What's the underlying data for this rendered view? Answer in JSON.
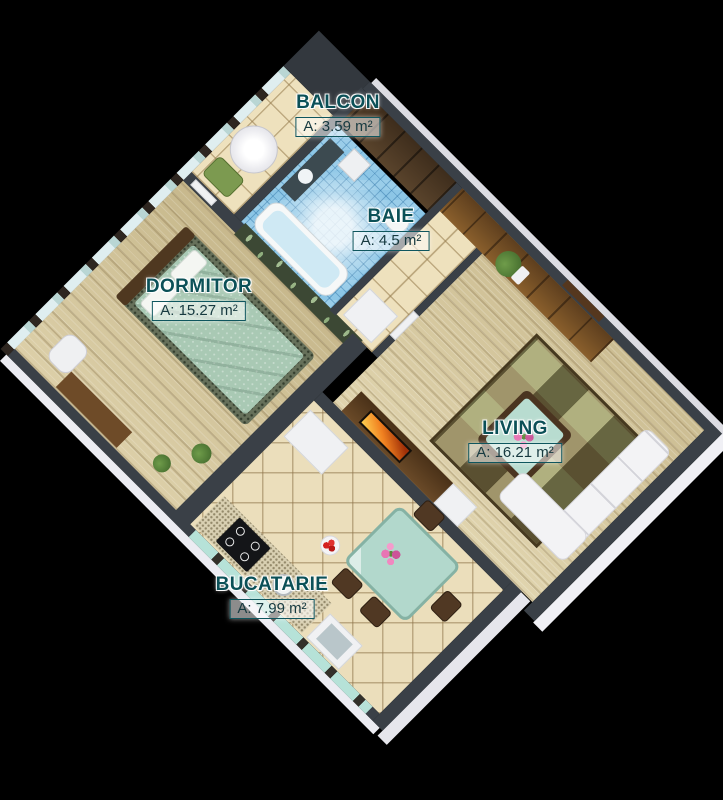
{
  "scene": {
    "description": "3D isometric apartment floor plan render on black background",
    "background": "#000000",
    "palette": {
      "label_text": "#0b5057",
      "label_box_border": "#0f565e",
      "label_box_bg": "rgba(255,255,255,0.55)",
      "wall_top": "#3a4047",
      "wall_face_white": "#ececf2",
      "wood_floor": "#d6c8a0",
      "tile_floor": "#eee1bd",
      "bath_mosaic": "#8cc6e6",
      "bed_cover": "#a9c9b4",
      "accent_leaf_wall": "#3c4834",
      "kitchen_glass": "#b6e2d8"
    }
  },
  "rooms": [
    {
      "id": "balcon",
      "name": "BALCON",
      "area_label": "A: 3.59 m²"
    },
    {
      "id": "baie",
      "name": "BAIE",
      "area_label": "A: 4.5 m²"
    },
    {
      "id": "dormitor",
      "name": "DORMITOR",
      "area_label": "A: 15.27 m²"
    },
    {
      "id": "living",
      "name": "LIVING",
      "area_label": "A: 16.21 m²"
    },
    {
      "id": "bucatarie",
      "name": "BUCATARIE",
      "area_label": "A: 7.99 m²"
    }
  ]
}
